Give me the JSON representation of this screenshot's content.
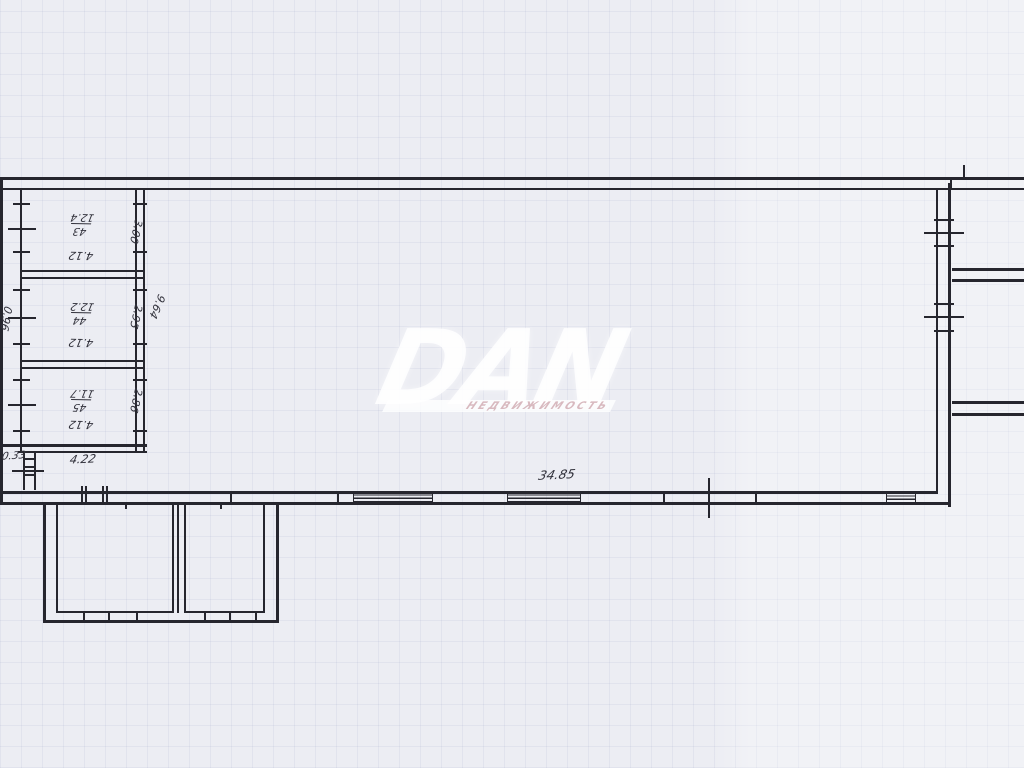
{
  "colors": {
    "paper": "#ecedf3",
    "ink": "#26262e",
    "watermark": "#ffffff",
    "watermark_subtitle": "#d6b5bc"
  },
  "watermark": {
    "brand": "DAN",
    "subtitle": "НЕДВИЖИМОСТЬ"
  },
  "labels": {
    "overall_width": "34.85",
    "porch_width": "4.22",
    "left_offset": "0.33",
    "left_wall_height": "0.96",
    "block_total_depth": "9.64"
  },
  "rooms": [
    {
      "number": "43",
      "area": "12.4",
      "width": "4.12",
      "depth": "3.00"
    },
    {
      "number": "44",
      "area": "12.2",
      "width": "4.12",
      "depth": "2.95"
    },
    {
      "number": "45",
      "area": "11.7",
      "width": "4.12",
      "depth": "2.86"
    }
  ]
}
